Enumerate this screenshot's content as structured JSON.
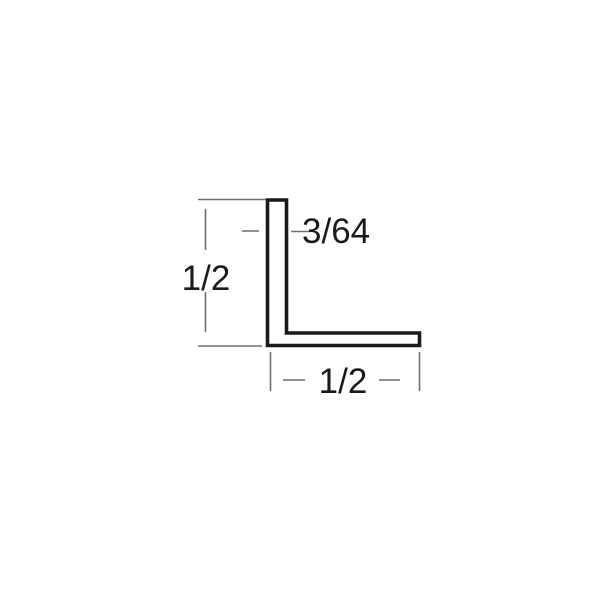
{
  "diagram": {
    "name": "L-angle profile cross-section dimension drawing",
    "dimensions": {
      "height_label": "1/2",
      "thickness_label": "3/64",
      "width_label": "1/2"
    },
    "colors": {
      "background": "#ffffff",
      "outline": "#1a1a1a",
      "annotation": "#6f6f6f",
      "text": "#1a1a1a",
      "fill": "#ffffff"
    }
  }
}
